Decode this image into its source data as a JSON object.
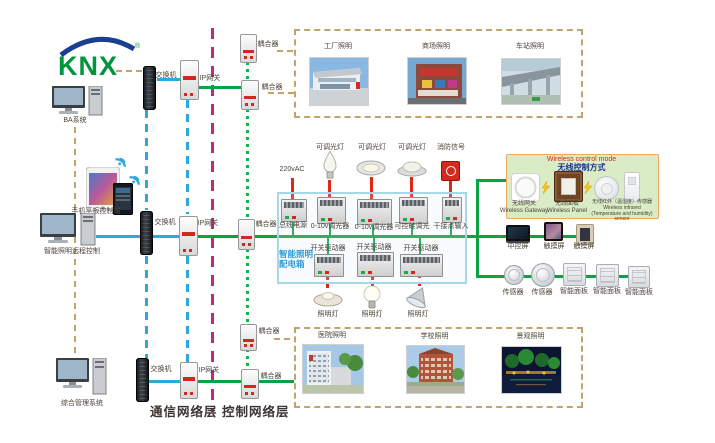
{
  "logo": {
    "text": "KNX"
  },
  "left": {
    "computers": [
      {
        "label": "BA系统"
      },
      {
        "label": "智能照明远程控制"
      },
      {
        "label": "综合管理系统"
      }
    ],
    "mobile_label": "手机平板控制端"
  },
  "network": {
    "switch_label": "交换机",
    "gateway_label": "IP网关",
    "coupler_label": "耦合器"
  },
  "layers": {
    "communication": "通信网络层",
    "control": "控制网络层"
  },
  "galleries": {
    "top": [
      {
        "label": "工厂照明"
      },
      {
        "label": "商场照明"
      },
      {
        "label": "车站照明"
      }
    ],
    "bottom": [
      {
        "label": "医院照明"
      },
      {
        "label": "学校照明"
      },
      {
        "label": "景观照明"
      }
    ]
  },
  "cabinet": {
    "title": "智能照明配电箱",
    "power_input": "220vAC",
    "top_row": [
      {
        "device": "总线电源",
        "load": ""
      },
      {
        "device": "0-10v调光器",
        "load": "可调光灯"
      },
      {
        "device": "0-10v调光器",
        "load": "可调光灯"
      },
      {
        "device": "可控硅调光",
        "load": "可调光灯"
      },
      {
        "device": "干接点输入",
        "load": "消防信号"
      }
    ],
    "bottom_row": [
      {
        "device": "开关驱动器",
        "load": "照明灯"
      },
      {
        "device": "开关驱动器",
        "load": "照明灯"
      },
      {
        "device": "开关驱动器",
        "load": "照明灯"
      }
    ]
  },
  "wireless": {
    "title_en": "Wireless control mode",
    "title_zh": "无线控制方式",
    "devices": [
      {
        "zh": "无线网关",
        "en": "Wireless Gateway"
      },
      {
        "zh": "无线面板",
        "en": "Wireless Panel"
      },
      {
        "zh": "无线红外（温湿度）传感器",
        "en": "Wireless infrared (Temperature and humidity) sensor"
      }
    ]
  },
  "terminals": {
    "screens": [
      {
        "label": "中控屏"
      },
      {
        "label": "触摸屏"
      },
      {
        "label": "触摸屏"
      }
    ],
    "sensors": [
      {
        "label": "传感器"
      },
      {
        "label": "传感器"
      }
    ],
    "panels": [
      {
        "label": "智能面板"
      },
      {
        "label": "智能面板"
      },
      {
        "label": "智能面板"
      }
    ]
  },
  "colors": {
    "bus_green": "#0aa344",
    "lan_blue": "#2fa8e0",
    "layer_magenta": "#bb2a7d",
    "aux_tan": "#c2a36b",
    "power_red": "#e52418",
    "cabinet_border": "#a6d8ea",
    "cabinet_title": "#2b9cd8",
    "wireless_bg": "#d9ecc5",
    "wireless_border": "#eda963"
  }
}
